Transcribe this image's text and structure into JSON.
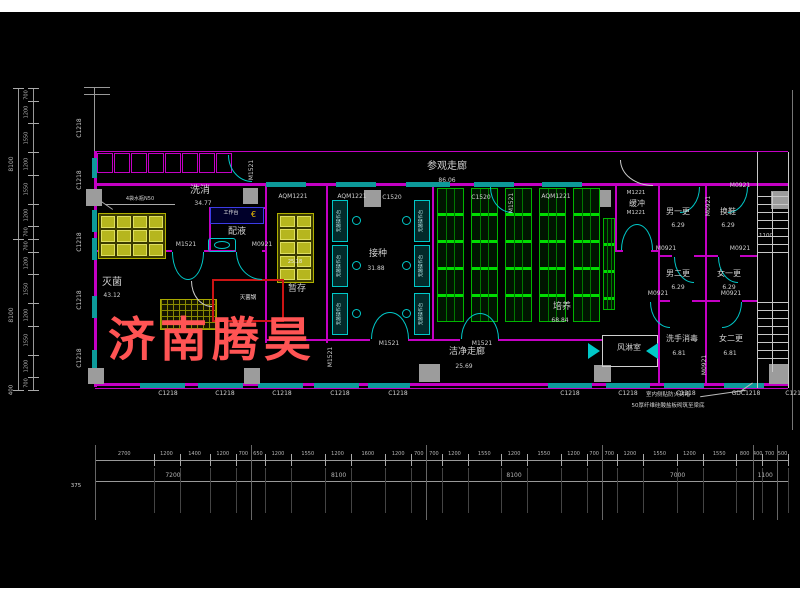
{
  "watermark": {
    "text": "济南腾昊",
    "color": "#ff5454"
  },
  "rooms": [
    {
      "name": "参观走廊",
      "area": "86.06"
    },
    {
      "name": "洗消",
      "area": "34.77"
    },
    {
      "name": "配液",
      "area": ""
    },
    {
      "name": "灭菌",
      "area": "43.12"
    },
    {
      "name": "暂存",
      "area": "25.18"
    },
    {
      "name": "接种",
      "area": "31.88"
    },
    {
      "name": "培养",
      "area": "68.84"
    },
    {
      "name": "洁净走廊",
      "area": "25.69"
    },
    {
      "name": "缓冲",
      "area": ""
    },
    {
      "name": "风淋室",
      "area": ""
    },
    {
      "name": "男一更",
      "area": "6.29"
    },
    {
      "name": "换鞋",
      "area": "6.29"
    },
    {
      "name": "男二更",
      "area": "6.29"
    },
    {
      "name": "女一更",
      "area": "6.29"
    },
    {
      "name": "洗手消毒",
      "area": "6.81"
    },
    {
      "name": "女二更",
      "area": "6.81"
    }
  ],
  "door_window_codes": [
    "C1218",
    "C1520",
    "GDC1218",
    "M1521",
    "M0921",
    "M1221",
    "AQM1221"
  ],
  "equipment": {
    "sterilizer": "灭菌锅",
    "workbench": "工作台",
    "clean_bench": "无菌操作台",
    "rack_note": "4袋水瓶N50",
    "storage_rack_value": "25.18",
    "stair_width": "1100"
  },
  "notes": {
    "line1": "室内侧贴防火封堵",
    "line2": "50厚纤维硅酸盐板砌筑至梁底"
  },
  "dimensions": {
    "bottom": {
      "segments": [
        2700,
        1200,
        1400,
        1200,
        700,
        650,
        1200,
        1550,
        1200,
        1600,
        1200,
        700,
        700,
        1200,
        1550,
        1200,
        1550,
        1200,
        700,
        700,
        1200,
        1550,
        1200,
        1550,
        800,
        400,
        700,
        500
      ],
      "totals": [
        7200,
        8100,
        8100,
        7000,
        1100
      ],
      "offset_left": "375"
    },
    "left": {
      "segments": [
        700,
        1200,
        1550,
        1200,
        1550,
        1200,
        700,
        700,
        1200,
        1550,
        1200,
        1550,
        1200,
        700
      ],
      "totals": [
        8100,
        8100
      ],
      "offset_bottom": "400"
    }
  },
  "labels": [
    {
      "t": "参观走廊",
      "x": 447,
      "y": 162,
      "s": 10,
      "n": "room-visit-corridor"
    },
    {
      "t": "86.06",
      "x": 447,
      "y": 178,
      "s": 6
    },
    {
      "t": "洗消",
      "x": 200,
      "y": 186,
      "s": 10,
      "n": "room-washing"
    },
    {
      "t": "34.77",
      "x": 203,
      "y": 201,
      "s": 6
    },
    {
      "t": "配液",
      "x": 237,
      "y": 228,
      "s": 9,
      "n": "room-liquid-prep"
    },
    {
      "t": "灭菌",
      "x": 112,
      "y": 278,
      "s": 10,
      "n": "room-sterilization"
    },
    {
      "t": "43.12",
      "x": 112,
      "y": 293,
      "s": 6
    },
    {
      "t": "暂存",
      "x": 297,
      "y": 285,
      "s": 9,
      "n": "room-temp-storage"
    },
    {
      "t": "25.18",
      "x": 295,
      "y": 260,
      "s": 5,
      "c": "#e8e8e8"
    },
    {
      "t": "接种",
      "x": 378,
      "y": 250,
      "s": 9,
      "n": "room-inoculation"
    },
    {
      "t": "31.88",
      "x": 376,
      "y": 266,
      "s": 6
    },
    {
      "t": "培养",
      "x": 562,
      "y": 303,
      "s": 9,
      "n": "room-cultivation"
    },
    {
      "t": "68.84",
      "x": 560,
      "y": 318,
      "s": 6
    },
    {
      "t": "洁净走廊",
      "x": 467,
      "y": 348,
      "s": 9,
      "n": "room-clean-corridor"
    },
    {
      "t": "25.69",
      "x": 464,
      "y": 364,
      "s": 6
    },
    {
      "t": "M1221",
      "x": 636,
      "y": 191,
      "s": 5.5
    },
    {
      "t": "缓冲",
      "x": 637,
      "y": 200,
      "s": 8,
      "n": "room-buffer"
    },
    {
      "t": "M1221",
      "x": 636,
      "y": 211,
      "s": 5.5
    },
    {
      "t": "风淋室",
      "x": 629,
      "y": 344,
      "s": 8,
      "n": "room-air-shower"
    },
    {
      "t": "男一更",
      "x": 678,
      "y": 208,
      "s": 8,
      "n": "room-men-change-1"
    },
    {
      "t": "6.29",
      "x": 678,
      "y": 223,
      "s": 6
    },
    {
      "t": "换鞋",
      "x": 728,
      "y": 208,
      "s": 8,
      "n": "room-shoe-change"
    },
    {
      "t": "6.29",
      "x": 728,
      "y": 223,
      "s": 6
    },
    {
      "t": "男二更",
      "x": 678,
      "y": 270,
      "s": 8,
      "n": "room-men-change-2"
    },
    {
      "t": "6.29",
      "x": 678,
      "y": 285,
      "s": 6
    },
    {
      "t": "女一更",
      "x": 729,
      "y": 270,
      "s": 8,
      "n": "room-women-change-1"
    },
    {
      "t": "6.29",
      "x": 729,
      "y": 285,
      "s": 6
    },
    {
      "t": "洗手消毒",
      "x": 682,
      "y": 335,
      "s": 8,
      "n": "room-hand-wash"
    },
    {
      "t": "6.81",
      "x": 679,
      "y": 351,
      "s": 6
    },
    {
      "t": "女二更",
      "x": 731,
      "y": 335,
      "s": 8,
      "n": "room-women-change-2"
    },
    {
      "t": "6.81",
      "x": 730,
      "y": 351,
      "s": 6
    },
    {
      "t": "AQM1221",
      "x": 293,
      "y": 194,
      "s": 6
    },
    {
      "t": "AQM1221",
      "x": 352,
      "y": 194,
      "s": 6
    },
    {
      "t": "C1520",
      "x": 392,
      "y": 195,
      "s": 6
    },
    {
      "t": "C1520",
      "x": 481,
      "y": 195,
      "s": 6
    },
    {
      "t": "AQM1221",
      "x": 556,
      "y": 194,
      "s": 6
    },
    {
      "t": "M0921",
      "x": 740,
      "y": 183,
      "s": 6
    },
    {
      "t": "M1521",
      "x": 186,
      "y": 242,
      "s": 6
    },
    {
      "t": "M0921",
      "x": 262,
      "y": 242,
      "s": 6
    },
    {
      "t": "M1521",
      "x": 389,
      "y": 341,
      "s": 6
    },
    {
      "t": "M1521",
      "x": 482,
      "y": 341,
      "s": 6
    },
    {
      "t": "M0921",
      "x": 666,
      "y": 246,
      "s": 6
    },
    {
      "t": "M0921",
      "x": 740,
      "y": 246,
      "s": 6
    },
    {
      "t": "M0921",
      "x": 658,
      "y": 291,
      "s": 6
    },
    {
      "t": "M0921",
      "x": 731,
      "y": 291,
      "s": 6
    },
    {
      "t": "M1521",
      "x": 252,
      "y": 170,
      "s": 6,
      "v": 1
    },
    {
      "t": "M1521",
      "x": 512,
      "y": 203,
      "s": 6,
      "v": 1
    },
    {
      "t": "M0921",
      "x": 709,
      "y": 206,
      "s": 6,
      "v": 1
    },
    {
      "t": "M0921",
      "x": 705,
      "y": 365,
      "s": 6,
      "v": 1
    },
    {
      "t": "M1521",
      "x": 331,
      "y": 357,
      "s": 6,
      "v": 1
    },
    {
      "t": "1100",
      "x": 766,
      "y": 234,
      "s": 5.5
    },
    {
      "t": "C1218",
      "x": 168,
      "y": 391,
      "s": 6
    },
    {
      "t": "C1218",
      "x": 225,
      "y": 391,
      "s": 6
    },
    {
      "t": "C1218",
      "x": 282,
      "y": 391,
      "s": 6
    },
    {
      "t": "C1218",
      "x": 340,
      "y": 391,
      "s": 6
    },
    {
      "t": "C1218",
      "x": 398,
      "y": 391,
      "s": 6
    },
    {
      "t": "C1218",
      "x": 570,
      "y": 391,
      "s": 6
    },
    {
      "t": "C1218",
      "x": 628,
      "y": 391,
      "s": 6
    },
    {
      "t": "C1218",
      "x": 686,
      "y": 391,
      "s": 6
    },
    {
      "t": "GDC1218",
      "x": 746,
      "y": 391,
      "s": 6
    },
    {
      "t": "C1218",
      "x": 795,
      "y": 391,
      "s": 6
    },
    {
      "t": "C1218",
      "x": 80,
      "y": 128,
      "s": 6,
      "v": 1
    },
    {
      "t": "C1218",
      "x": 80,
      "y": 180,
      "s": 6,
      "v": 1
    },
    {
      "t": "C1218",
      "x": 80,
      "y": 242,
      "s": 6,
      "v": 1
    },
    {
      "t": "C1218",
      "x": 80,
      "y": 300,
      "s": 6,
      "v": 1
    },
    {
      "t": "C1218",
      "x": 80,
      "y": 358,
      "s": 6,
      "v": 1
    },
    {
      "t": "灭菌锅",
      "x": 248,
      "y": 296,
      "s": 5.5,
      "c": "#e8e8e8",
      "n": "equip-sterilizer-label"
    },
    {
      "t": "工作台",
      "x": 231,
      "y": 211,
      "s": 5,
      "c": "#e8e8e8",
      "n": "equip-workbench-label"
    },
    {
      "t": "4袋水瓶N50",
      "x": 140,
      "y": 197,
      "s": 5,
      "n": "equip-rack-note"
    },
    {
      "t": "无菌操作台",
      "x": 340,
      "y": 221,
      "s": 4.5,
      "v": 1,
      "c": "#bfeeee"
    },
    {
      "t": "无菌操作台",
      "x": 340,
      "y": 266,
      "s": 4.5,
      "v": 1,
      "c": "#bfeeee"
    },
    {
      "t": "无菌操作台",
      "x": 340,
      "y": 314,
      "s": 4.5,
      "v": 1,
      "c": "#bfeeee"
    },
    {
      "t": "无菌操作台",
      "x": 422,
      "y": 221,
      "s": 4.5,
      "v": 1,
      "c": "#bfeeee"
    },
    {
      "t": "无菌操作台",
      "x": 422,
      "y": 266,
      "s": 4.5,
      "v": 1,
      "c": "#bfeeee"
    },
    {
      "t": "无菌操作台",
      "x": 422,
      "y": 314,
      "s": 4.5,
      "v": 1,
      "c": "#bfeeee"
    },
    {
      "t": "室内侧贴防火封堵",
      "x": 668,
      "y": 393,
      "s": 5.5,
      "n": "note-line1"
    },
    {
      "t": "50厚纤维硅酸盐板砌筑至梁底",
      "x": 668,
      "y": 404,
      "s": 5.5,
      "n": "note-line2"
    },
    {
      "t": "400",
      "x": 12,
      "y": 390,
      "s": 5.5,
      "v": 1
    },
    {
      "t": "375",
      "x": 76,
      "y": 484,
      "s": 5.5
    }
  ]
}
